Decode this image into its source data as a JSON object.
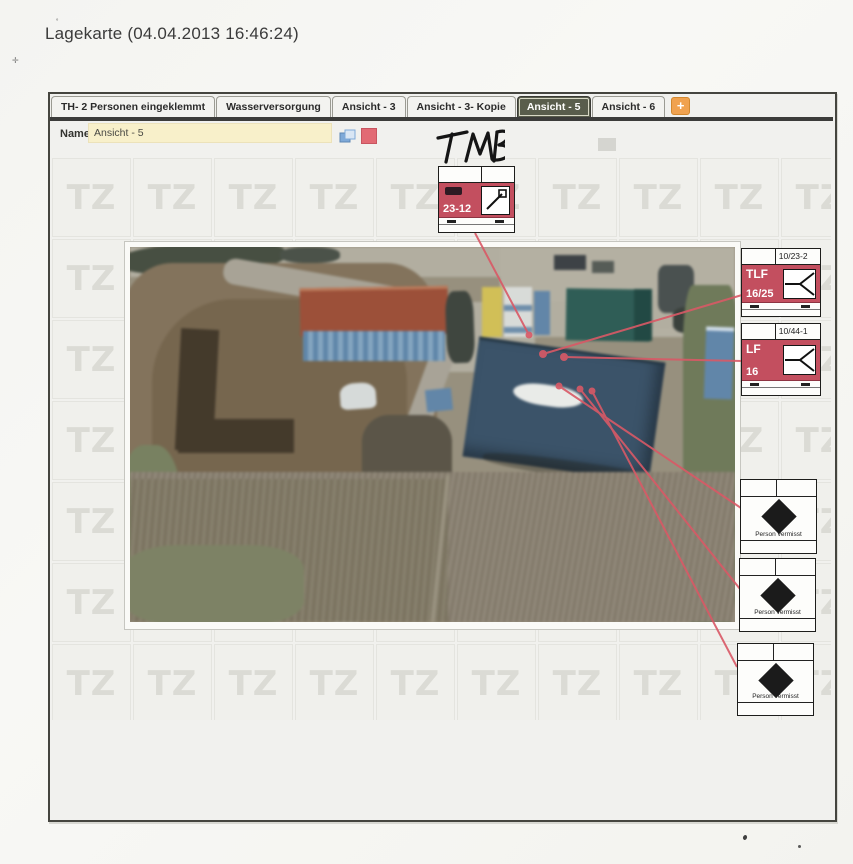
{
  "page": {
    "title": "Lagekarte (04.04.2013 16:46:24)"
  },
  "tab_bar": {
    "tabs": [
      {
        "label": "TH- 2 Personen eingeklemmt",
        "selected": false
      },
      {
        "label": "Wasserversorgung",
        "selected": false
      },
      {
        "label": "Ansicht - 3",
        "selected": false
      },
      {
        "label": "Ansicht - 3- Kopie",
        "selected": false
      },
      {
        "label": "Ansicht - 5",
        "selected": true
      },
      {
        "label": "Ansicht - 6",
        "selected": false
      }
    ],
    "add_button": "+"
  },
  "toolbar": {
    "name_label": "Name",
    "name_value": "Ansicht - 5"
  },
  "watermark": {
    "text": "TZ",
    "grid": {
      "cols": 10,
      "rows": 7,
      "pitch_px": 81
    }
  },
  "handwriting": {
    "text": "TMB"
  },
  "map_symbols": {
    "aerial_unit": {
      "id": "23-12"
    },
    "vehicles": [
      {
        "callsign": "10/23-2",
        "type": "TLF",
        "designation": "16/25"
      },
      {
        "callsign": "10/44-1",
        "type": "LF",
        "designation": "16"
      }
    ],
    "missing_persons": [
      {
        "label": "Person vermisst"
      },
      {
        "label": "Person vermisst"
      },
      {
        "label": "Person vermisst"
      }
    ]
  },
  "colors": {
    "symbol_band_red": "#c34f5f",
    "annotation_line_red": "#d95966",
    "selected_tab_olive": "#595d4c",
    "name_input_cream": "#f8f0ca",
    "add_button_orange": "#f0a24f",
    "swatch_red": "#e26a74"
  }
}
